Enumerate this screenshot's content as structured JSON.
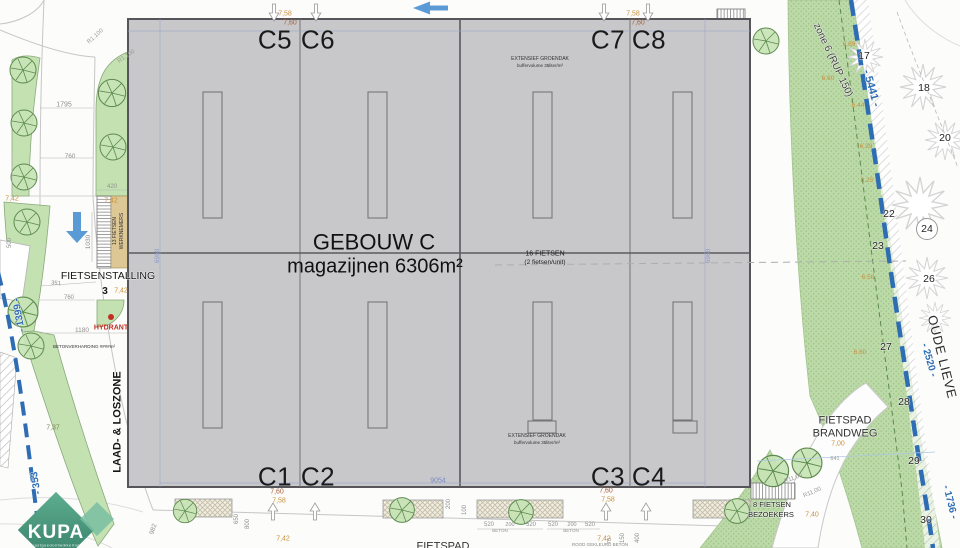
{
  "plan": {
    "building": {
      "name": "GEBOUW C",
      "subtitle": "magazijnen 6306m²",
      "units_top": [
        "C5",
        "C6",
        "C7",
        "C8"
      ],
      "units_bottom": [
        "C1",
        "C2",
        "C3",
        "C4"
      ]
    },
    "logo": {
      "name": "KUPA",
      "tagline": "vastgoedontwikkeling"
    },
    "colors": {
      "boundary_blue": "#2e6db4",
      "building_gray": "#c8c8ca",
      "green": "#c3e1b1",
      "dim_orange": "#c9913f",
      "arrow_blue": "#5b9bd5",
      "hydrant_red": "#c03024"
    },
    "annotations": [
      {
        "n": "roof-note",
        "t": "EXTENSIEF GROENDAK",
        "x": 540,
        "y": 59,
        "fs": 5,
        "c": "#333333"
      },
      {
        "n": "roof-note",
        "t": "buffervolume 35liter/m²",
        "x": 540,
        "y": 66,
        "fs": 4.5,
        "c": "#333333"
      },
      {
        "n": "roof-note",
        "t": "EXTENSIEF GROENDAK",
        "x": 537,
        "y": 436,
        "fs": 5,
        "c": "#333333"
      },
      {
        "n": "roof-note",
        "t": "buffervolume 35liter/m²",
        "x": 537,
        "y": 443,
        "fs": 4.5,
        "c": "#333333"
      },
      {
        "n": "bike-note",
        "t": "16 FIETSEN",
        "x": 545,
        "y": 253,
        "fs": 7,
        "c": "#222222"
      },
      {
        "n": "bike-note",
        "t": "(2 fietsen/unit)",
        "x": 545,
        "y": 262,
        "fs": 6.5,
        "c": "#222222"
      },
      {
        "n": "dim-label",
        "t": "7,58",
        "x": 285,
        "y": 13,
        "fs": 7,
        "c": "#c9913f"
      },
      {
        "n": "dim-label",
        "t": "7,60",
        "x": 290,
        "y": 22,
        "fs": 7,
        "c": "#a7603a"
      },
      {
        "n": "dim-label",
        "t": "7,58",
        "x": 633,
        "y": 13,
        "fs": 7,
        "c": "#c9913f"
      },
      {
        "n": "dim-label",
        "t": "7,60",
        "x": 638,
        "y": 22,
        "fs": 7,
        "c": "#a7603a"
      },
      {
        "n": "dim-label",
        "t": "7,60",
        "x": 277,
        "y": 491,
        "fs": 7,
        "c": "#a7603a"
      },
      {
        "n": "dim-label",
        "t": "7,58",
        "x": 279,
        "y": 500,
        "fs": 7,
        "c": "#c9913f"
      },
      {
        "n": "dim-label",
        "t": "7,60",
        "x": 606,
        "y": 490,
        "fs": 7,
        "c": "#a7603a"
      },
      {
        "n": "dim-label",
        "t": "7,58",
        "x": 608,
        "y": 499,
        "fs": 7,
        "c": "#c9913f"
      },
      {
        "n": "dim-label",
        "t": "7,42",
        "x": 12,
        "y": 198,
        "fs": 7,
        "c": "#c9913f"
      },
      {
        "n": "dim-label",
        "t": "7,42",
        "x": 111,
        "y": 200,
        "fs": 7,
        "c": "#c9913f"
      },
      {
        "n": "dim-label",
        "t": "7,42",
        "x": 121,
        "y": 290,
        "fs": 7,
        "c": "#c9913f"
      },
      {
        "n": "dim-label",
        "t": "7,42",
        "x": 283,
        "y": 538,
        "fs": 7,
        "c": "#c9913f"
      },
      {
        "n": "dim-label",
        "t": "7,42",
        "x": 604,
        "y": 538,
        "fs": 7,
        "c": "#c9913f"
      },
      {
        "n": "dim-label",
        "t": "7,37",
        "x": 53,
        "y": 427,
        "fs": 7,
        "c": "#7d8c5e"
      },
      {
        "n": "dim-label",
        "t": "7,00",
        "x": 838,
        "y": 443,
        "fs": 7,
        "c": "#c9913f"
      },
      {
        "n": "dim-label",
        "t": "7,40",
        "x": 812,
        "y": 514,
        "fs": 7,
        "c": "#c9913f"
      },
      {
        "n": "level-label",
        "t": "6.89",
        "x": 849,
        "y": 44,
        "fs": 6.5,
        "c": "#c9913f"
      },
      {
        "n": "level-label",
        "t": "6.60",
        "x": 828,
        "y": 78,
        "fs": 6.5,
        "c": "#c9913f"
      },
      {
        "n": "level-label",
        "t": "6.44",
        "x": 858,
        "y": 105,
        "fs": 6.5,
        "c": "#c9913f"
      },
      {
        "n": "level-label",
        "t": "6.39",
        "x": 866,
        "y": 146,
        "fs": 6.5,
        "c": "#c9913f"
      },
      {
        "n": "level-label",
        "t": "6.25",
        "x": 867,
        "y": 180,
        "fs": 6.5,
        "c": "#c9913f"
      },
      {
        "n": "level-label",
        "t": "6.58",
        "x": 868,
        "y": 277,
        "fs": 6.5,
        "c": "#c9913f"
      },
      {
        "n": "level-label",
        "t": "6.60",
        "x": 860,
        "y": 352,
        "fs": 6.5,
        "c": "#c9913f"
      },
      {
        "n": "dim-label",
        "t": "1795",
        "x": 64,
        "y": 104,
        "fs": 7,
        "c": "#8f8f8f"
      },
      {
        "n": "dim-label",
        "t": "760",
        "x": 70,
        "y": 156,
        "fs": 6.5,
        "c": "#8f8f8f"
      },
      {
        "n": "dim-label",
        "t": "420",
        "x": 112,
        "y": 186,
        "fs": 6,
        "c": "#8f8f8f"
      },
      {
        "n": "dim-label",
        "t": "500",
        "x": 9,
        "y": 243,
        "fs": 6,
        "r": -90,
        "c": "#8f8f8f"
      },
      {
        "n": "dim-label",
        "t": "1030",
        "x": 88,
        "y": 242,
        "fs": 6.5,
        "r": -90,
        "c": "#8f8f8f"
      },
      {
        "n": "dim-label",
        "t": "351",
        "x": 56,
        "y": 283,
        "fs": 6,
        "r": 6,
        "c": "#8f8f8f"
      },
      {
        "n": "dim-label",
        "t": "760",
        "x": 69,
        "y": 297,
        "fs": 6,
        "c": "#8f8f8f"
      },
      {
        "n": "dim-label",
        "t": "1180",
        "x": 82,
        "y": 330,
        "fs": 6.5,
        "c": "#8f8f8f"
      },
      {
        "n": "dim-label",
        "t": "982",
        "x": 153,
        "y": 529,
        "fs": 6.5,
        "r": -72,
        "c": "#8f8f8f"
      },
      {
        "n": "dim-label",
        "t": "650",
        "x": 236,
        "y": 519,
        "fs": 6,
        "r": -90,
        "c": "#8f8f8f"
      },
      {
        "n": "dim-label",
        "t": "800",
        "x": 247,
        "y": 524,
        "fs": 6,
        "r": -90,
        "c": "#8f8f8f"
      },
      {
        "n": "dim-label",
        "t": "200",
        "x": 448,
        "y": 504,
        "fs": 6,
        "r": -90,
        "c": "#8f8f8f"
      },
      {
        "n": "dim-label",
        "t": "100",
        "x": 464,
        "y": 510,
        "fs": 6,
        "r": -90,
        "c": "#8f8f8f"
      },
      {
        "n": "dim-label",
        "t": "520",
        "x": 489,
        "y": 524,
        "fs": 6,
        "c": "#8f8f8f"
      },
      {
        "n": "dim-label",
        "t": "200",
        "x": 510,
        "y": 525,
        "fs": 5.5,
        "c": "#8f8f8f"
      },
      {
        "n": "dim-label",
        "t": "520",
        "x": 531,
        "y": 524,
        "fs": 6,
        "c": "#8f8f8f"
      },
      {
        "n": "dim-label",
        "t": "BETON",
        "x": 500,
        "y": 531,
        "fs": 4.5,
        "c": "#8f8f8f"
      },
      {
        "n": "dim-label",
        "t": "520",
        "x": 553,
        "y": 524,
        "fs": 6,
        "c": "#8f8f8f"
      },
      {
        "n": "dim-label",
        "t": "200",
        "x": 572,
        "y": 525,
        "fs": 5.5,
        "c": "#8f8f8f"
      },
      {
        "n": "dim-label",
        "t": "520",
        "x": 590,
        "y": 524,
        "fs": 6,
        "c": "#8f8f8f"
      },
      {
        "n": "dim-label",
        "t": "BETON",
        "x": 571,
        "y": 531,
        "fs": 4.5,
        "c": "#8f8f8f"
      },
      {
        "n": "dim-label",
        "t": "73",
        "x": 610,
        "y": 541,
        "fs": 5.5,
        "r": -90,
        "c": "#8f8f8f"
      },
      {
        "n": "dim-label",
        "t": "150",
        "x": 622,
        "y": 538,
        "fs": 6,
        "r": -90,
        "c": "#8f8f8f"
      },
      {
        "n": "dim-label",
        "t": "400",
        "x": 637,
        "y": 538,
        "fs": 6,
        "r": -90,
        "c": "#8f8f8f"
      },
      {
        "n": "radius-label",
        "t": "R1.100",
        "x": 95,
        "y": 36,
        "fs": 6,
        "r": -42,
        "c": "#9a9a9a"
      },
      {
        "n": "radius-label",
        "t": "R1.100",
        "x": 126,
        "y": 56,
        "fs": 6,
        "r": -34,
        "c": "#9a9a9a"
      },
      {
        "n": "radius-label",
        "t": "R11,00",
        "x": 793,
        "y": 478,
        "fs": 6,
        "r": -20,
        "c": "#9a9a9a"
      },
      {
        "n": "radius-label",
        "t": "R11,00",
        "x": 812,
        "y": 492,
        "fs": 6,
        "r": -24,
        "c": "#9a9a9a"
      },
      {
        "n": "dim-label",
        "t": "641",
        "x": 835,
        "y": 459,
        "fs": 5.5,
        "c": "#9a9a9a"
      },
      {
        "n": "dim-label",
        "t": "6960",
        "x": 157,
        "y": 256,
        "fs": 6.5,
        "r": -90,
        "c": "#8a97c9"
      },
      {
        "n": "dim-label",
        "t": "6960",
        "x": 708,
        "y": 256,
        "fs": 6.5,
        "r": -90,
        "c": "#8a97c9"
      },
      {
        "n": "dim-label",
        "t": "9054",
        "x": 438,
        "y": 480,
        "fs": 7,
        "c": "#7b8cc4"
      },
      {
        "n": "boundary-label",
        "t": "- 1399 -",
        "x": 19,
        "y": 315,
        "fs": 10,
        "r": -100,
        "c": "#2e6db4",
        "b": 1,
        "h": 1
      },
      {
        "n": "boundary-label",
        "t": "- 353",
        "x": 36,
        "y": 483,
        "fs": 10,
        "r": -100,
        "c": "#2e6db4",
        "b": 1,
        "h": 1
      },
      {
        "n": "boundary-label",
        "t": "- 5441 -",
        "x": 872,
        "y": 88,
        "fs": 11,
        "r": 74,
        "c": "#2e6db4",
        "b": 1,
        "h": 1
      },
      {
        "n": "boundary-label",
        "t": "- 2520 -",
        "x": 929,
        "y": 360,
        "fs": 10,
        "r": 74,
        "c": "#2e6db4",
        "b": 1,
        "h": 1
      },
      {
        "n": "boundary-label",
        "t": "- 1736 -",
        "x": 950,
        "y": 502,
        "fs": 10,
        "r": 76,
        "c": "#2e6db4",
        "b": 1,
        "h": 1
      },
      {
        "n": "zone-label",
        "t": "zone 6 (RUP 150)",
        "x": 833,
        "y": 60,
        "fs": 10,
        "r": 65,
        "c": "#3c3c3c",
        "h": 1
      },
      {
        "n": "waterway-label",
        "t": "OUDE LIEVE",
        "x": 942,
        "y": 357,
        "fs": 13,
        "r": 76,
        "c": "#2a2a2a",
        "ls": 1.5,
        "h": 1
      },
      {
        "n": "path-label",
        "t": "FIETSPAD",
        "x": 845,
        "y": 420,
        "fs": 11,
        "c": "#333333",
        "h": 1
      },
      {
        "n": "path-label",
        "t": "BRANDWEG",
        "x": 845,
        "y": 433,
        "fs": 11,
        "c": "#333333",
        "h": 1
      },
      {
        "n": "tree-number",
        "t": "17",
        "x": 864,
        "y": 56,
        "fs": 10.5,
        "c": "#222222",
        "h": 1
      },
      {
        "n": "tree-number",
        "t": "18",
        "x": 924,
        "y": 88,
        "fs": 10.5,
        "c": "#222222",
        "h": 1
      },
      {
        "n": "tree-number",
        "t": "20",
        "x": 945,
        "y": 138,
        "fs": 10.5,
        "c": "#222222",
        "h": 1
      },
      {
        "n": "tree-number",
        "t": "22",
        "x": 889,
        "y": 214,
        "fs": 10.5,
        "c": "#222222",
        "h": 1
      },
      {
        "n": "tree-number",
        "t": "23",
        "x": 878,
        "y": 246,
        "fs": 10.5,
        "c": "#222222",
        "h": 1
      },
      {
        "n": "tree-number",
        "t": "24",
        "x": 927,
        "y": 229,
        "fs": 10.5,
        "c": "#222222",
        "h": 1
      },
      {
        "n": "tree-number",
        "t": "26",
        "x": 929,
        "y": 279,
        "fs": 10.5,
        "c": "#222222",
        "h": 1
      },
      {
        "n": "tree-number",
        "t": "27",
        "x": 886,
        "y": 347,
        "fs": 10.5,
        "c": "#222222",
        "h": 1
      },
      {
        "n": "tree-number",
        "t": "28",
        "x": 904,
        "y": 402,
        "fs": 10.5,
        "c": "#222222",
        "h": 1
      },
      {
        "n": "tree-number",
        "t": "29",
        "x": 914,
        "y": 461,
        "fs": 10.5,
        "c": "#222222",
        "h": 1
      },
      {
        "n": "tree-number",
        "t": "30",
        "x": 926,
        "y": 520,
        "fs": 10.5,
        "c": "#222222",
        "h": 1
      },
      {
        "n": "area-label",
        "t": "FIETSENSTALLING",
        "x": 108,
        "y": 276,
        "fs": 10.5,
        "c": "#151515",
        "h": 1
      },
      {
        "n": "area-label",
        "t": "3",
        "x": 105,
        "y": 291,
        "fs": 10,
        "b": 1,
        "c": "#151515"
      },
      {
        "n": "hydrant-label",
        "t": "HYDRANT",
        "x": 111,
        "y": 327,
        "fs": 7,
        "b": 1,
        "c": "#c03024"
      },
      {
        "n": "area-label",
        "t": "BETONVERHARDING ####m²",
        "x": 84,
        "y": 347,
        "fs": 4.5,
        "c": "#333333"
      },
      {
        "n": "area-label",
        "t": "LAAD- & LOSZONE",
        "x": 117,
        "y": 422,
        "fs": 11,
        "r": -90,
        "b": 1,
        "c": "#151515",
        "h": 1
      },
      {
        "n": "rack-label",
        "t": "13 FIETSEN",
        "x": 115,
        "y": 231,
        "fs": 5,
        "r": -90,
        "c": "#333333"
      },
      {
        "n": "rack-label",
        "t": "WERKNEMERS",
        "x": 122,
        "y": 231,
        "fs": 5,
        "r": -90,
        "c": "#333333"
      },
      {
        "n": "rack-label",
        "t": "8 FIETSEN",
        "x": 772,
        "y": 505,
        "fs": 7.5,
        "c": "#222222",
        "h": 1
      },
      {
        "n": "rack-label",
        "t": "BEZOEKERS",
        "x": 771,
        "y": 515,
        "fs": 7.5,
        "c": "#222222",
        "h": 1
      },
      {
        "n": "path-label",
        "t": "FIETSPAD",
        "x": 443,
        "y": 546,
        "fs": 11,
        "c": "#333333"
      },
      {
        "n": "path-label",
        "t": "ROOD GEKLEURD BETON",
        "x": 600,
        "y": 545,
        "fs": 4.5,
        "c": "#888888"
      }
    ]
  }
}
